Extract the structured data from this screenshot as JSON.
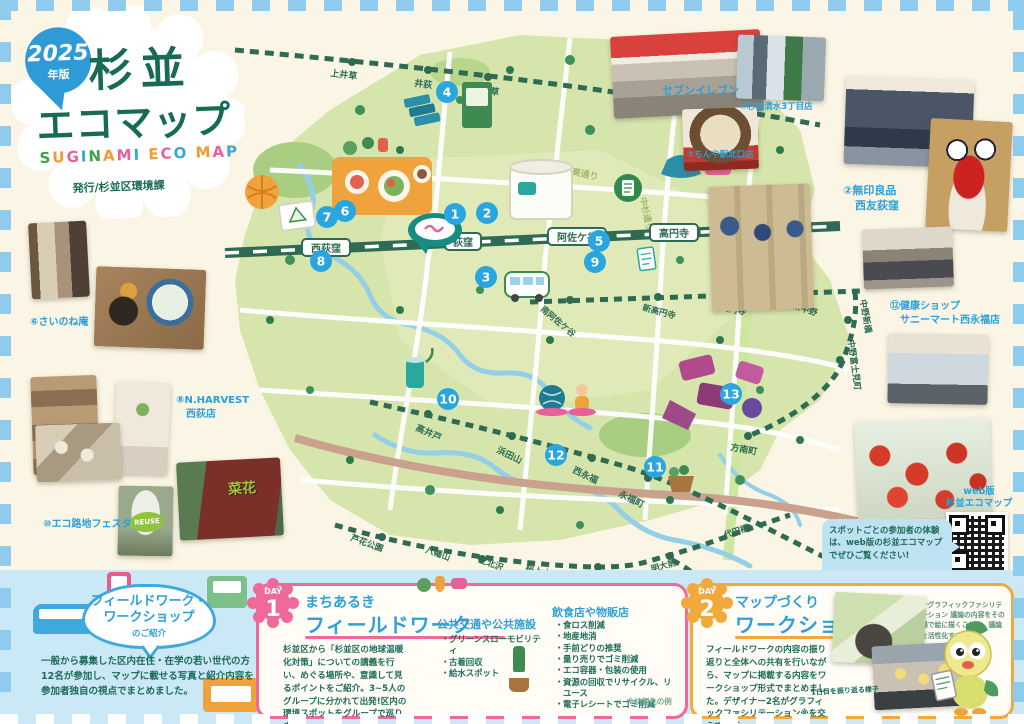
{
  "logo": {
    "badge_year": "2025",
    "badge_suffix": "年版",
    "title_line1": "杉並",
    "title_line2": "エコマップ",
    "subtitle": "SUGINAMI ECO MAP",
    "subtitle_colors": [
      "#43A047",
      "#F29A38",
      "#E8609A",
      "#35A8D8"
    ],
    "publisher": "発行/杉並区環境課"
  },
  "map": {
    "stations": {
      "chuo": [
        "西荻窪",
        "荻窪",
        "阿佐ケ谷",
        "高円寺",
        "中野"
      ],
      "seibu": [
        "上井草",
        "井荻",
        "下井草"
      ],
      "marunouchi": [
        "南阿佐ケ谷",
        "新高円寺",
        "東高円寺",
        "新中野",
        "中野新橋",
        "中野富士見町",
        "方南町"
      ],
      "inokashira": [
        "高井戸",
        "浜田山",
        "西永福",
        "永福町"
      ],
      "keio": [
        "芦花公園",
        "八幡山",
        "上北沢",
        "桜上水",
        "下高井戸",
        "明大前",
        "代田橋"
      ]
    },
    "roads": {
      "nichidai": "日大二高通り",
      "nakasugi": "中杉通り"
    },
    "markers": [
      "1",
      "2",
      "3",
      "4",
      "5",
      "6",
      "7",
      "8",
      "9",
      "10",
      "11",
      "12",
      "13"
    ]
  },
  "photos": {
    "seven_eleven": {
      "caption": "セブンイレブン",
      "branch": "④杉並清水3丁目店"
    },
    "gyoza": {
      "caption": "⑦ちんや駅北口店"
    },
    "muji": {
      "caption_line1": "②無印良品",
      "caption_line2": "西友荻窪"
    },
    "sunnymart": {
      "caption_line1": "⑫健康ショップ",
      "caption_line2": "サニーマート西永福店"
    },
    "sainone": {
      "caption": "⑥さいのね庵"
    },
    "nharvest": {
      "caption_line1": "⑧N.HARVEST",
      "caption_line2": "西荻店"
    },
    "ecoroji": {
      "caption": "⑩エコ路地フェスタ"
    },
    "reuse_cup_text": "REUSE",
    "gypsy_sign_text": "菜花"
  },
  "web": {
    "label_line1": "web版",
    "label_line2": "杉並エコマップ",
    "bubble": "スポットごとの参加者の体験は、web版の杉並エコマップでぜひご覧ください!"
  },
  "intro": {
    "title_line1": "フィールドワーク・",
    "title_line2": "ワークショップ",
    "title_line3": "のご紹介",
    "body": "一般から募集した区内在住・在学の若い世代の方12名が参加し、マップに載せる写真と紹介内容を参加者独自の視点でまとめました。"
  },
  "day1": {
    "badge_label": "DAY",
    "badge_number": "1",
    "title_line1": "まちあるき",
    "title_line2": "フィールドワーク",
    "body": "杉並区から「杉並区の地球温暖化対策」についての講義を行い、めぐる場所や、意識して見るポイントをご紹介。3~5人のグループに分かれて出発!区内の環境スポットをグループで巡りました。",
    "facilities": {
      "title": "公共交通や公共施設",
      "items": [
        "グリーンスローモビリティ",
        "古着回収",
        "給水スポット"
      ]
    },
    "shops": {
      "title": "飲食店や物販店",
      "items": [
        "食ロス削減",
        "地産地消",
        "手前どりの推奨",
        "量り売りでゴミ削減",
        "エコ容器・包装の使用",
        "資源の回収でリサイクル、リユース",
        "電子レシートでゴミ削減"
      ]
    },
    "note": "※訪問先の例"
  },
  "day2": {
    "badge_label": "DAY",
    "badge_number": "2",
    "title_line1": "マップづくり",
    "title_line2": "ワークショップ",
    "body": "フィールドワークの内容の振り返りと全体への共有を行いながら、マップに掲載する内容をワークショップ形式でまとめました。デザイナー2名がグラフィックファシリテーション※を交えて進行。",
    "note": "※グラフィックファシリテーション 議論の内容をその場で絵に描くことで、議論を活性化する手法",
    "photo_caption": "1日目を振り返る様子"
  },
  "colors": {
    "accent_blue": "#2AA0DB",
    "marker_blue": "#29A6DF",
    "day1_pink": "#F0699A",
    "day2_orange": "#F2A93B",
    "deep_green": "#176B54",
    "rail_green": "#2E6B52",
    "band_blue": "#CBE8F6",
    "cream": "#FAF5E4"
  }
}
